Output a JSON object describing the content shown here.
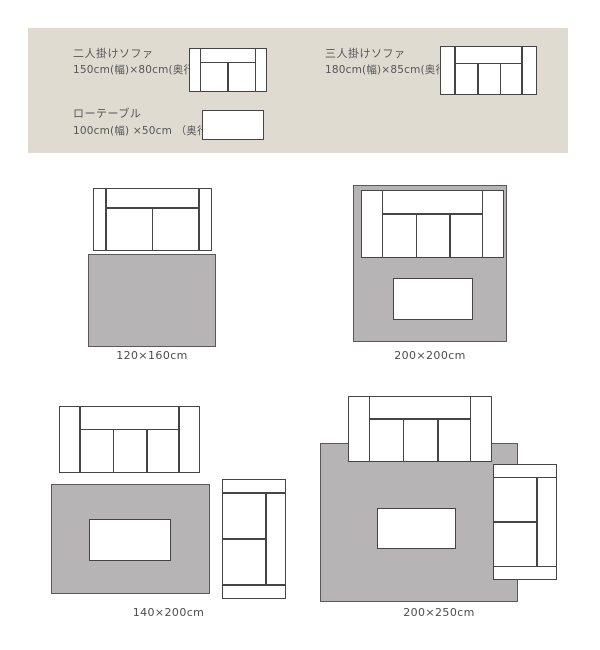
{
  "legend": {
    "items": [
      {
        "name": "二人掛けソファ",
        "size": "150cm(幅)×80cm(奥行)",
        "icon": "two-seater-sofa-icon"
      },
      {
        "name": "三人掛けソファ",
        "size": "180cm(幅)×85cm(奥行)",
        "icon": "three-seater-sofa-icon"
      },
      {
        "name": "ローテーブル",
        "size": "100cm(幅) ×50cm （奥行）",
        "icon": "low-table-icon"
      }
    ]
  },
  "diagrams": [
    {
      "label": "120×160cm",
      "furniture": [
        "two-seater-sofa",
        "rug"
      ]
    },
    {
      "label": "200×200cm",
      "furniture": [
        "three-seater-sofa",
        "low-table",
        "rug"
      ]
    },
    {
      "label": "140×200cm",
      "furniture": [
        "three-seater-sofa",
        "low-table",
        "two-seater-sofa-rotated",
        "rug"
      ]
    },
    {
      "label": "200×250cm",
      "furniture": [
        "three-seater-sofa",
        "low-table",
        "two-seater-sofa-rotated",
        "rug"
      ]
    }
  ],
  "colors": {
    "legend_bg": "#dfdbd1",
    "rug_fill": "#b6b4b4",
    "rug_border": "#5d5757",
    "furniture_outline": "#454545",
    "furniture_fill": "#ffffff",
    "text": "#565656"
  }
}
